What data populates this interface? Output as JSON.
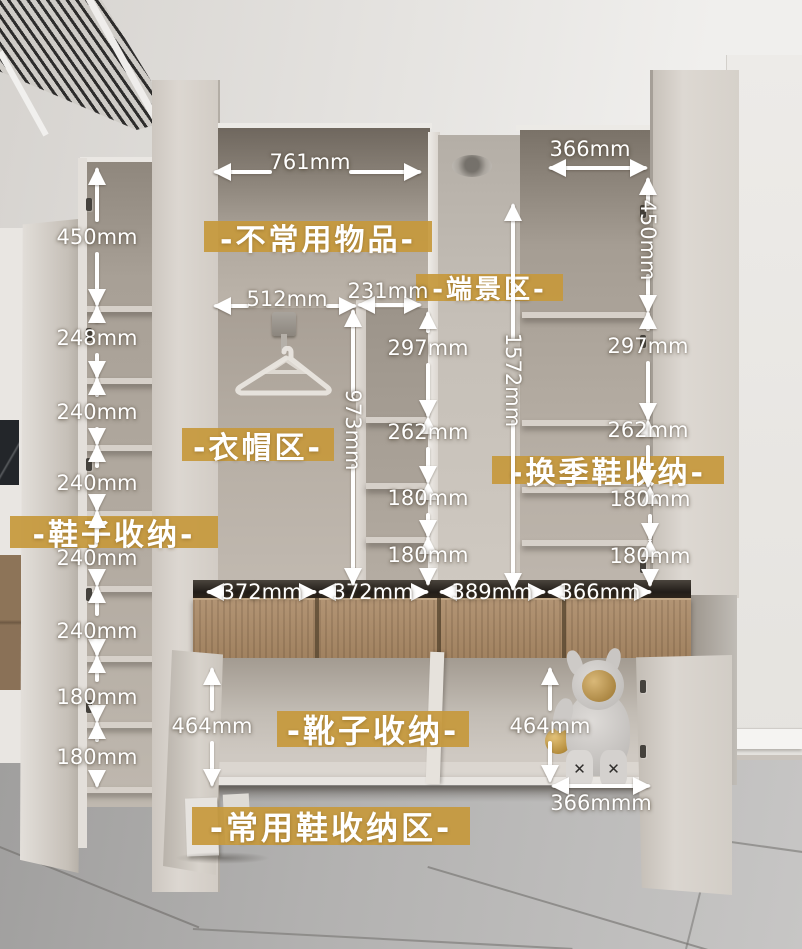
{
  "photo": {
    "toy_foot_mark": "✕"
  },
  "annotations": {
    "zone_labels": [
      {
        "id": "infrequent-items",
        "text": "-不常用物品-",
        "x": 204,
        "y": 221,
        "w": 228,
        "h": 31,
        "fs": 30
      },
      {
        "id": "end-view-area",
        "text": "-端景区-",
        "x": 416,
        "y": 274,
        "w": 147,
        "h": 27,
        "fs": 26
      },
      {
        "id": "clothing-area",
        "text": "-衣帽区-",
        "x": 182,
        "y": 428,
        "w": 152,
        "h": 33,
        "fs": 30
      },
      {
        "id": "seasonal-shoe-storage",
        "text": "-换季鞋收纳-",
        "x": 492,
        "y": 456,
        "w": 232,
        "h": 28,
        "fs": 30
      },
      {
        "id": "shoe-storage",
        "text": "-鞋子收纳-",
        "x": 10,
        "y": 516,
        "w": 208,
        "h": 32,
        "fs": 30
      },
      {
        "id": "boot-storage",
        "text": "-靴子收纳-",
        "x": 277,
        "y": 711,
        "w": 192,
        "h": 36,
        "fs": 32
      },
      {
        "id": "daily-shoe-area",
        "text": "-常用鞋收纳区-",
        "x": 192,
        "y": 807,
        "w": 278,
        "h": 38,
        "fs": 32
      }
    ],
    "h_dims": [
      {
        "text": "761mm",
        "x1": 214,
        "x2": 421,
        "y": 172,
        "tx": 310,
        "ty": 162
      },
      {
        "text": "366mm",
        "x1": 549,
        "x2": 647,
        "y": 168,
        "tx": 590,
        "ty": 149
      },
      {
        "text": "512mm",
        "x1": 214,
        "x2": 356,
        "y": 306,
        "tx": 287,
        "ty": 299
      },
      {
        "text": "231mm",
        "x1": 358,
        "x2": 421,
        "y": 305,
        "tx": 388,
        "ty": 291
      },
      {
        "text": "372mm",
        "x1": 207,
        "x2": 316,
        "y": 592,
        "tx": 262,
        "ty": 592
      },
      {
        "text": "372mm",
        "x1": 319,
        "x2": 428,
        "y": 592,
        "tx": 373,
        "ty": 592
      },
      {
        "text": "389mm",
        "x1": 440,
        "x2": 545,
        "y": 592,
        "tx": 492,
        "ty": 592
      },
      {
        "text": "366mm",
        "x1": 548,
        "x2": 651,
        "y": 592,
        "tx": 600,
        "ty": 592
      },
      {
        "text": "366mmm",
        "x1": 552,
        "x2": 650,
        "y": 786,
        "tx": 601,
        "ty": 803
      }
    ],
    "v_dims": [
      {
        "text": "450mm",
        "x": 97,
        "y1": 168,
        "y2": 306,
        "ty": 237
      },
      {
        "text": "248mm",
        "x": 97,
        "y1": 306,
        "y2": 378,
        "ty": 338
      },
      {
        "text": "240mm",
        "x": 97,
        "y1": 378,
        "y2": 445,
        "ty": 412
      },
      {
        "text": "240mm",
        "x": 97,
        "y1": 445,
        "y2": 511,
        "ty": 483
      },
      {
        "text": "240mm",
        "x": 97,
        "y1": 511,
        "y2": 586,
        "ty": 558
      },
      {
        "text": "240mm",
        "x": 97,
        "y1": 586,
        "y2": 656,
        "ty": 631
      },
      {
        "text": "180mm",
        "x": 97,
        "y1": 656,
        "y2": 722,
        "ty": 697
      },
      {
        "text": "180mm",
        "x": 97,
        "y1": 722,
        "y2": 787,
        "ty": 757
      },
      {
        "text": "973mm",
        "x": 353,
        "y1": 310,
        "y2": 585,
        "ty": 430,
        "rot": true
      },
      {
        "text": "1572mm",
        "x": 513,
        "y1": 204,
        "y2": 590,
        "ty": 380,
        "rot": true
      },
      {
        "text": "297mm",
        "x": 428,
        "y1": 312,
        "y2": 417,
        "ty": 348
      },
      {
        "text": "262mm",
        "x": 428,
        "y1": 417,
        "y2": 483,
        "ty": 432
      },
      {
        "text": "180mm",
        "x": 428,
        "y1": 483,
        "y2": 537,
        "ty": 498
      },
      {
        "text": "180mm",
        "x": 428,
        "y1": 537,
        "y2": 585,
        "ty": 555
      },
      {
        "text": "450mm",
        "x": 648,
        "y1": 178,
        "y2": 312,
        "ty": 240,
        "rot": true
      },
      {
        "text": "297mm",
        "x": 648,
        "y1": 312,
        "y2": 420,
        "ty": 346
      },
      {
        "text": "262mm",
        "x": 648,
        "y1": 420,
        "y2": 487,
        "ty": 430
      },
      {
        "text": "180mm",
        "x": 650,
        "y1": 487,
        "y2": 540,
        "ty": 499
      },
      {
        "text": "180mm",
        "x": 650,
        "y1": 540,
        "y2": 586,
        "ty": 556
      },
      {
        "text": "464mm",
        "x": 212,
        "y1": 668,
        "y2": 786,
        "ty": 726
      },
      {
        "text": "464mm",
        "x": 550,
        "y1": 668,
        "y2": 782,
        "ty": 726
      }
    ]
  },
  "colors": {
    "label_gold": "#c6993c",
    "arrow_white": "#ffffff",
    "drawer_wood": "#a98b6c",
    "cabinet_cream": "#d9d4ce",
    "floor_gray": "#aaa9a8"
  }
}
